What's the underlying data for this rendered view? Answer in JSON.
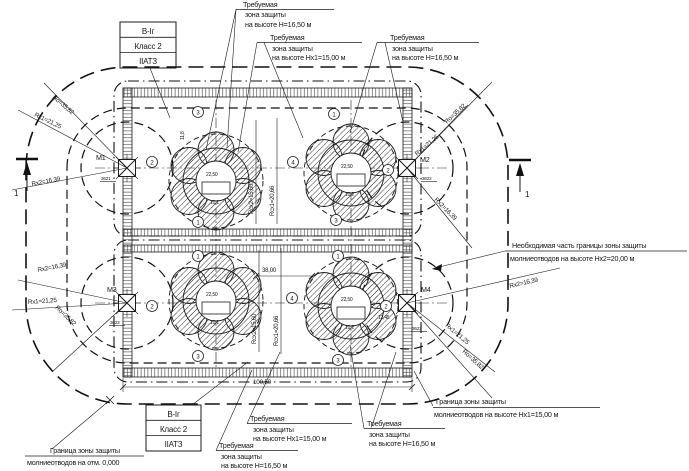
{
  "colors": {
    "ink": "#1b1b1b",
    "background": "#ffffff"
  },
  "class_box": {
    "line1": "В-Iг",
    "line2": "Класс 2",
    "line3": "IIАТЗ"
  },
  "labels": {
    "required_h": {
      "l1": "Требуемая",
      "l2": "зона защиты",
      "l3": "на высоте H=16,50 м"
    },
    "required_hx1": {
      "l1": "Требуемая",
      "l2": "зона защиты",
      "l3": "на высоте Hx1=15,00 м"
    },
    "necessary_part": {
      "l1": "Необходимая часть границы зоны защиты",
      "l2": "молниеотводов на высоте Hx2=20,00 м"
    },
    "boundary_hx1": {
      "l1": "Граница зоны защиты",
      "l2": "молниеотводов на высоте Hx1=15,00 м"
    },
    "boundary_zero": {
      "l1": "Граница зоны защиты",
      "l2": "молниеотводов на отм. 0,000"
    }
  },
  "masts": {
    "m1": {
      "name": "М1",
      "mark": "3621"
    },
    "m2": {
      "name": "М2",
      "mark": "3622"
    },
    "m3": {
      "name": "М3",
      "mark": "3623"
    },
    "m4": {
      "name": "М4",
      "mark": "3623"
    }
  },
  "radii": {
    "ro": "Ro=35,82",
    "rx1": "Rx1=21,25",
    "rx2": "Rx2=16,39"
  },
  "dims": {
    "overall": "100,50",
    "between": "38,00",
    "rcx1": "Rсх1=20,66",
    "rcx2": "Rсх2=15,60",
    "tank_dia": "22,50",
    "d_left": "10,1",
    "d_right": "10,2",
    "d_small": "12,45",
    "d_vert": "11,8"
  },
  "axis_bubbles": {
    "n1": "1",
    "n2": "2",
    "n3": "3",
    "n4": "4"
  },
  "section": {
    "num": "1"
  }
}
